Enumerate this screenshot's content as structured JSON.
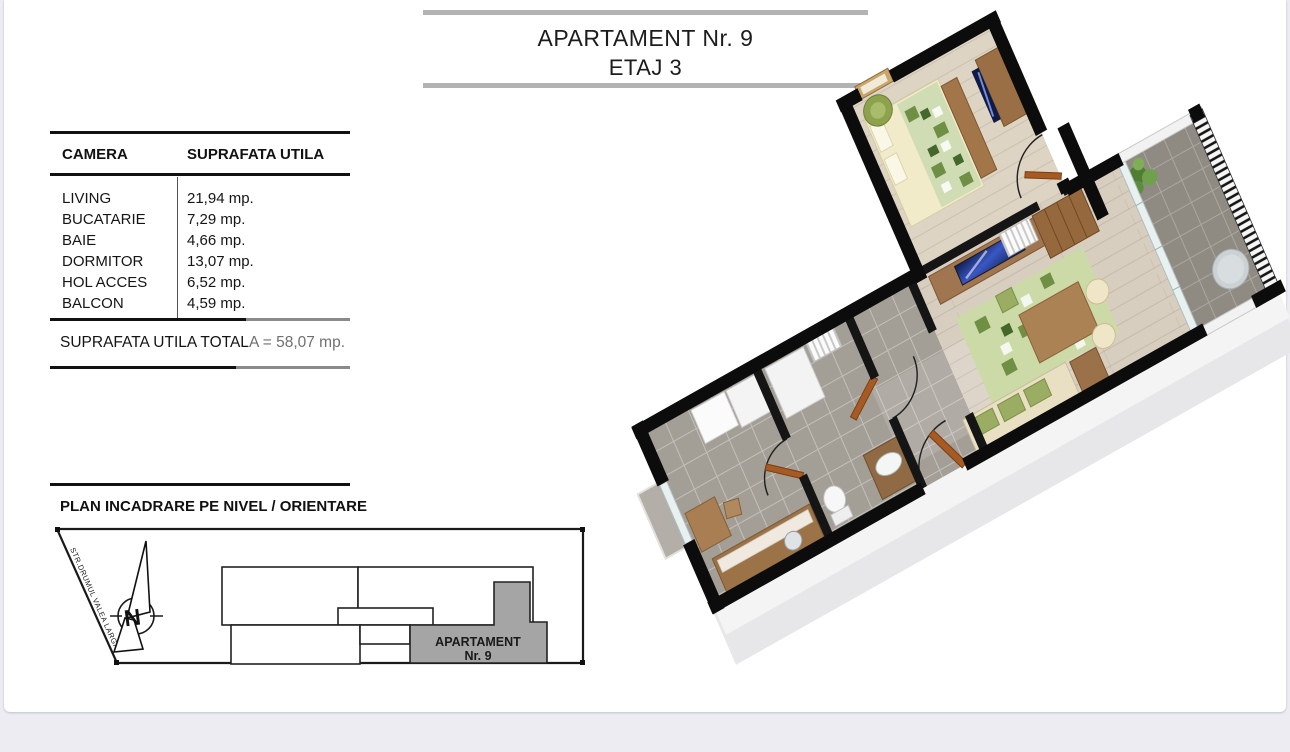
{
  "page": {
    "bg": "#ffffff",
    "outer_bg": "#ececf2"
  },
  "header": {
    "title_line1": "APARTAMENT Nr. 9",
    "title_line2": "ETAJ 3",
    "bar_color": "#b3b3b3"
  },
  "area_table": {
    "col1_header": "CAMERA",
    "col2_header": "SUPRAFATA UTILA",
    "rows": [
      {
        "room": "LIVING",
        "area": "21,94 mp."
      },
      {
        "room": "BUCATARIE",
        "area": "7,29 mp."
      },
      {
        "room": "BAIE",
        "area": "4,66 mp."
      },
      {
        "room": "DORMITOR",
        "area": "13,07 mp."
      },
      {
        "room": "HOL ACCES",
        "area": "6,52 mp."
      },
      {
        "room": "BALCON",
        "area": "4,59 mp."
      }
    ],
    "total_main": "SUPRAFATA UTILA TOTAL",
    "total_faded": "A = 58,07 mp."
  },
  "site_plan": {
    "heading": "PLAN INCADRARE PE NIVEL / ORIENTARE",
    "street_label": "STR.DRUMUL VALEA LARGA",
    "compass_letter": "N",
    "apartment_label_line1": "APARTAMENT",
    "apartment_label_line2": "Nr. 9",
    "highlight_color": "#a5a5a5"
  },
  "floor_plan_3d": {
    "type": "isometric-floorplan-render",
    "rooms": [
      "dormitor",
      "living",
      "bucatarie",
      "baie",
      "hol acces",
      "balcon"
    ],
    "colors": {
      "walls": "#0c0c0c",
      "wood_floor": "#d8cec0",
      "bedroom_floor": "#ddd4c4",
      "tile_floor": "#a39e96",
      "balcony_tile": "#8f8a82",
      "furniture_wood": "#a07650",
      "door": "#a65a24",
      "sofa_green": "#9aad62",
      "duvet": "#f1ebc9",
      "tv_screen": "#16275f"
    }
  }
}
